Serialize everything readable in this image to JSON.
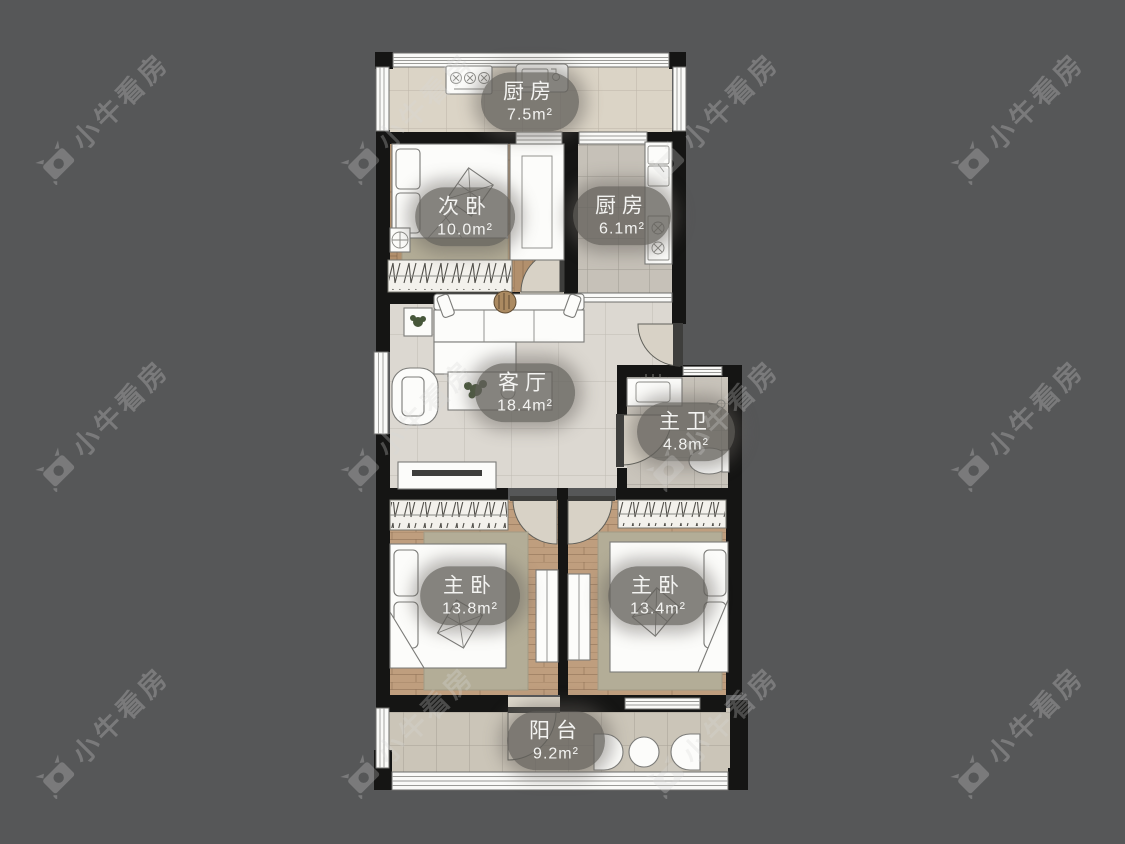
{
  "background": {
    "color": "#565758"
  },
  "watermark": {
    "text": "小牛看房",
    "icon": "bull-logo-icon",
    "color": "rgba(214,214,214,0.28)"
  },
  "plan": {
    "type": "residential-floorplan",
    "rooms": [
      {
        "id": "kitchen-top",
        "name": "厨房",
        "area": "7.5m²"
      },
      {
        "id": "bedroom-second",
        "name": "次卧",
        "area": "10.0m²"
      },
      {
        "id": "kitchen",
        "name": "厨房",
        "area": "6.1m²"
      },
      {
        "id": "living-room",
        "name": "客厅",
        "area": "18.4m²"
      },
      {
        "id": "master-bath",
        "name": "主卫",
        "area": "4.8m²"
      },
      {
        "id": "master-bedroom-left",
        "name": "主卧",
        "area": "13.8m²"
      },
      {
        "id": "master-bedroom-right",
        "name": "主卧",
        "area": "13.4m²"
      },
      {
        "id": "balcony",
        "name": "阳台",
        "area": "9.2m²"
      }
    ],
    "colors": {
      "wall": "#151514",
      "tile_light": "#dbd7d0",
      "tile_gray": "#c6c1b8",
      "wood": "#bf9e7e",
      "label_pill": "rgba(99,96,91,0.78)"
    }
  }
}
